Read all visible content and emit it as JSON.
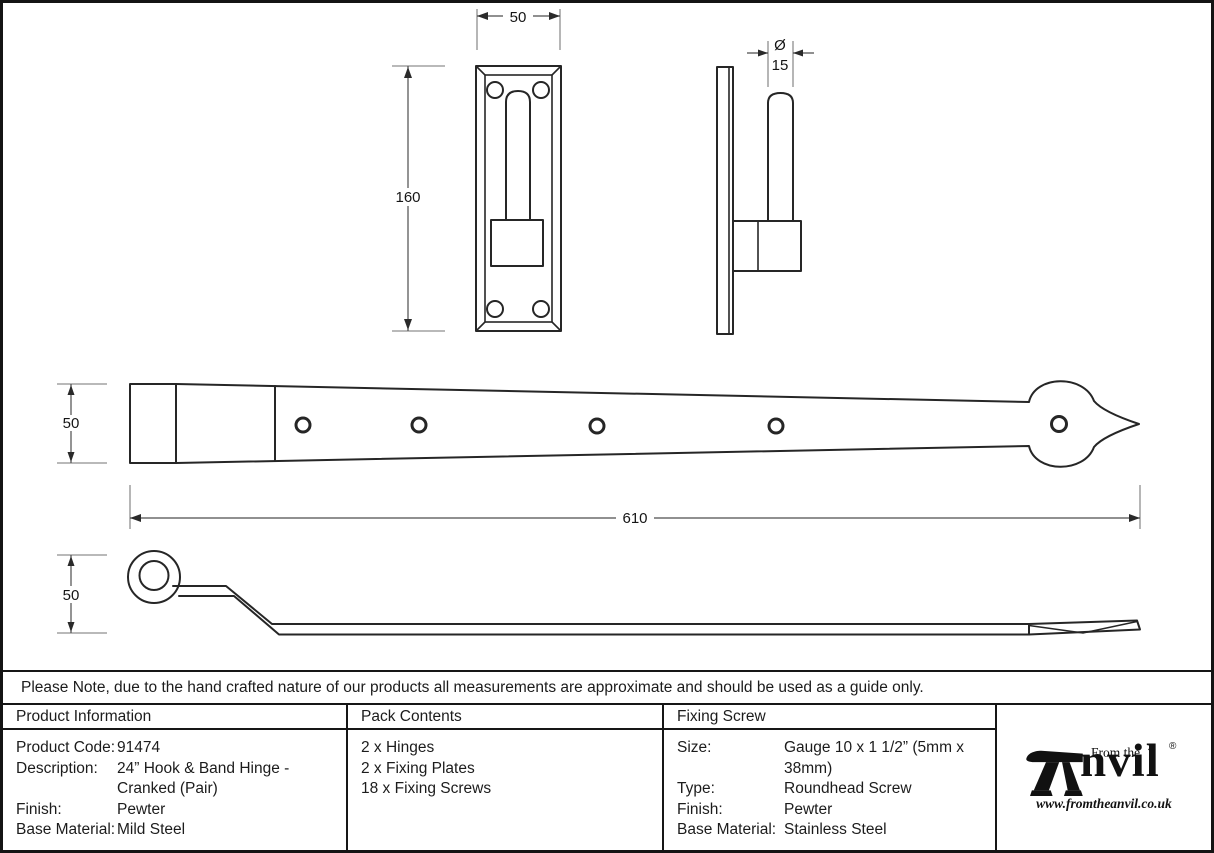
{
  "drawing": {
    "dims": {
      "plate_width": "50",
      "plate_height": "160",
      "diameter_symbol": "Ø",
      "pin_diameter": "15",
      "band_width": "50",
      "band_length": "610",
      "cranked_height": "50"
    }
  },
  "note": {
    "text": "Please Note, due to the hand crafted nature of our products all measurements are approximate and should be used as a guide only."
  },
  "table": {
    "product_information": {
      "header": "Product Information",
      "rows": [
        {
          "label": "Product Code:",
          "value": "91474"
        },
        {
          "label": "Description:",
          "value": "24” Hook & Band Hinge -",
          "value2": "Cranked (Pair)"
        },
        {
          "label": "Finish:",
          "value": "Pewter"
        },
        {
          "label": "Base Material:",
          "value": "Mild Steel"
        }
      ]
    },
    "pack_contents": {
      "header": "Pack Contents",
      "items": [
        "2 x Hinges",
        "2 x Fixing Plates",
        "18 x Fixing Screws"
      ]
    },
    "fixing_screw": {
      "header": "Fixing Screw",
      "rows": [
        {
          "label": "Size:",
          "value": "Gauge 10 x 1 1/2” (5mm x 38mm)"
        },
        {
          "label": "Type:",
          "value": "Roundhead Screw"
        },
        {
          "label": "Finish:",
          "value": "Pewter"
        },
        {
          "label": "Base Material:",
          "value": "Stainless Steel"
        }
      ]
    },
    "logo": {
      "from_the": "From the",
      "wordmark_rest": "nvil",
      "diamond": "◆",
      "registered": "®",
      "url": "www.fromtheanvil.co.uk"
    }
  }
}
